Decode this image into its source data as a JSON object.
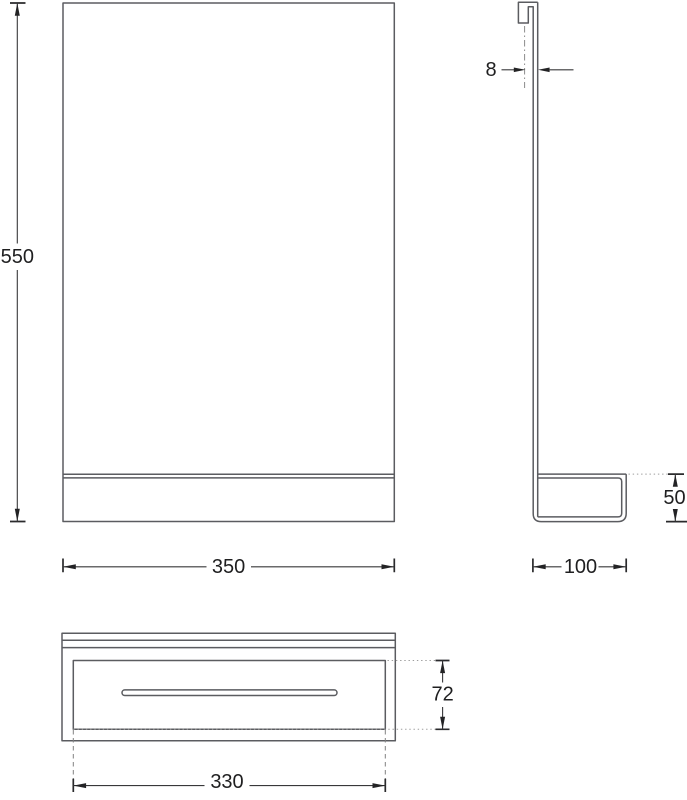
{
  "drawing": {
    "kind": "technical-orthographic-drawing",
    "subject": "mirror-with-shelf",
    "background_color": "#ffffff",
    "geometry_line_color": "#5b5c60",
    "dimension_line_color": "#38383a",
    "text_color": "#1f1f20",
    "views": {
      "front": {
        "name": "front-view"
      },
      "side": {
        "name": "side-view"
      },
      "bottom": {
        "name": "bottom-view"
      }
    },
    "dimensions": {
      "overall_height": {
        "label": "550",
        "value": 550
      },
      "overall_width": {
        "label": "350",
        "value": 350
      },
      "panel_thickness": {
        "label": "8",
        "value": 8
      },
      "shelf_depth": {
        "label": "100",
        "value": 100
      },
      "shelf_height": {
        "label": "50",
        "value": 50
      },
      "shelf_inner_depth": {
        "label": "72",
        "value": 72
      },
      "shelf_inner_width": {
        "label": "330",
        "value": 330
      }
    }
  }
}
